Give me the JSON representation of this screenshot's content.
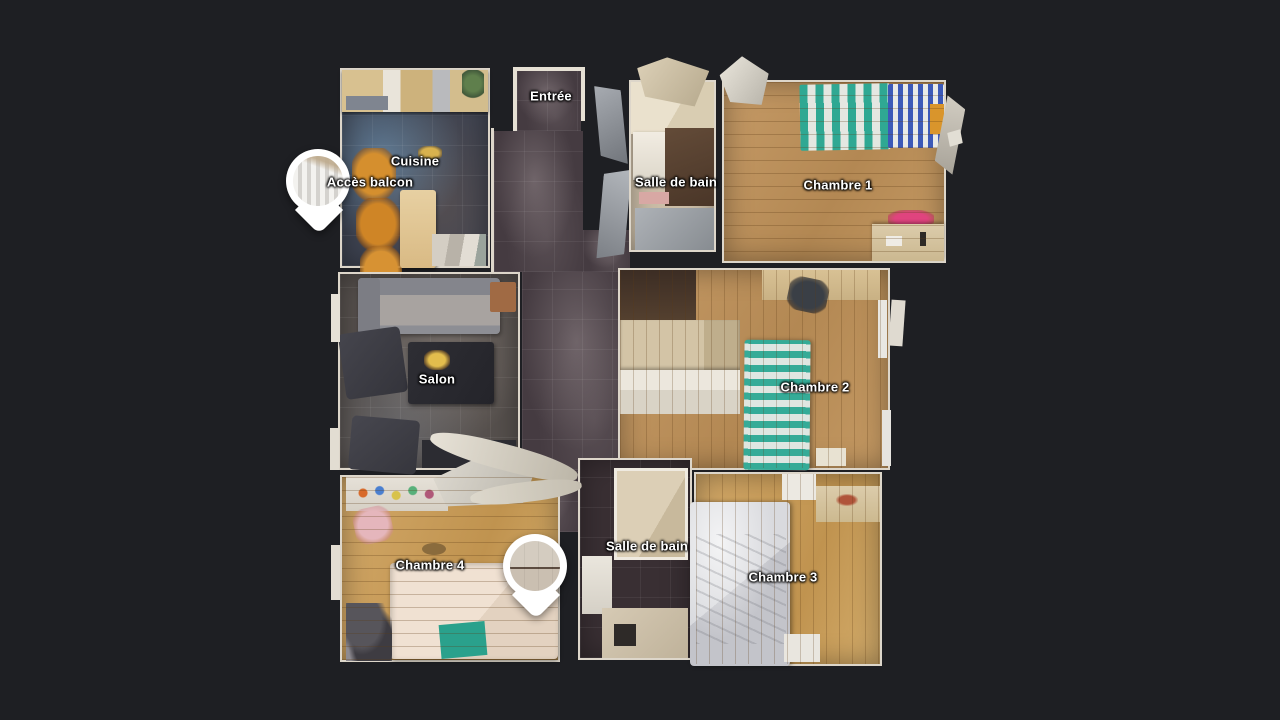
{
  "view": {
    "name": "3D floor plan top view",
    "background_color": "#1e1f23",
    "label_color": "#ffffff",
    "marker_color": "#ffffff"
  },
  "floorplan": {
    "rooms": [
      {
        "id": "entree",
        "label": "Entrée"
      },
      {
        "id": "cuisine",
        "label": "Cuisine"
      },
      {
        "id": "acces-balcon",
        "label": "Accès balcon"
      },
      {
        "id": "salle-de-bain-haut",
        "label": "Salle de bain"
      },
      {
        "id": "chambre-1",
        "label": "Chambre 1"
      },
      {
        "id": "salon",
        "label": "Salon"
      },
      {
        "id": "chambre-2",
        "label": "Chambre 2"
      },
      {
        "id": "chambre-4",
        "label": "Chambre 4"
      },
      {
        "id": "salle-de-bain-bas",
        "label": "Salle de bain"
      },
      {
        "id": "chambre-3",
        "label": "Chambre 3"
      }
    ],
    "markers": [
      {
        "id": "marker-acces-balcon",
        "thumbnail": "balcony-curtains-photo"
      },
      {
        "id": "marker-salle-de-bain",
        "thumbnail": "bathroom-wall-photo"
      }
    ],
    "floor_colors": {
      "wood": "#bf9360",
      "hall_tile": "#453b41",
      "kitchen_tile": "#3e4351",
      "salon_tile": "#56504d",
      "bathroom_dark_tile": "#392f33"
    }
  }
}
